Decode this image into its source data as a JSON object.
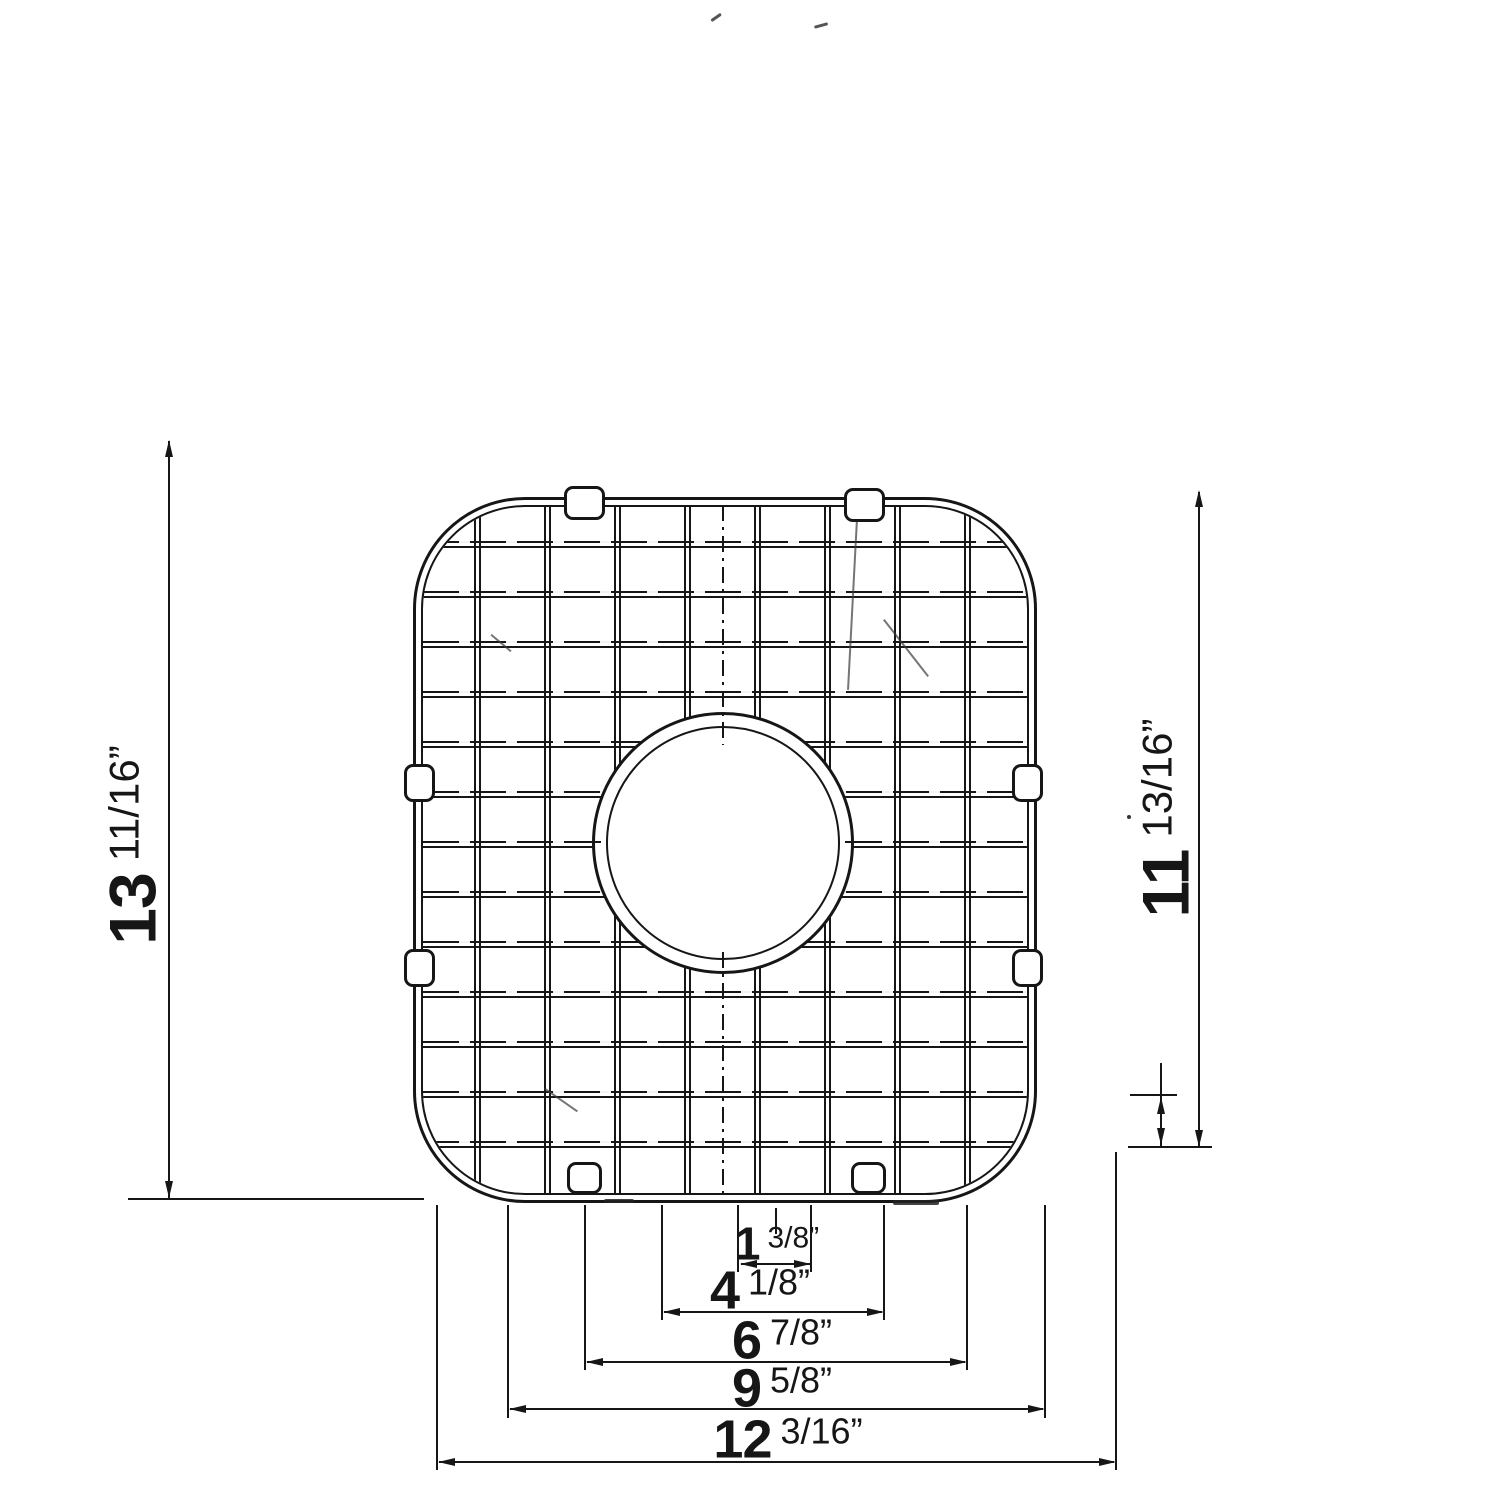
{
  "ink_color": "#161616",
  "paper_color": "#ffffff",
  "dims": {
    "left": {
      "whole": "13",
      "fraction": "11/16",
      "unit": "”"
    },
    "right": {
      "whole": "11",
      "fraction": "13/16",
      "unit": "”"
    },
    "bottom": [
      {
        "whole": "1",
        "fraction": "3/8",
        "unit": "”"
      },
      {
        "whole": "4",
        "fraction": "1/8",
        "unit": "”"
      },
      {
        "whole": "6",
        "fraction": "7/8",
        "unit": "”"
      },
      {
        "whole": "9",
        "fraction": "5/8",
        "unit": "”"
      },
      {
        "whole": "12",
        "fraction": "3/16",
        "unit": "”"
      }
    ]
  }
}
